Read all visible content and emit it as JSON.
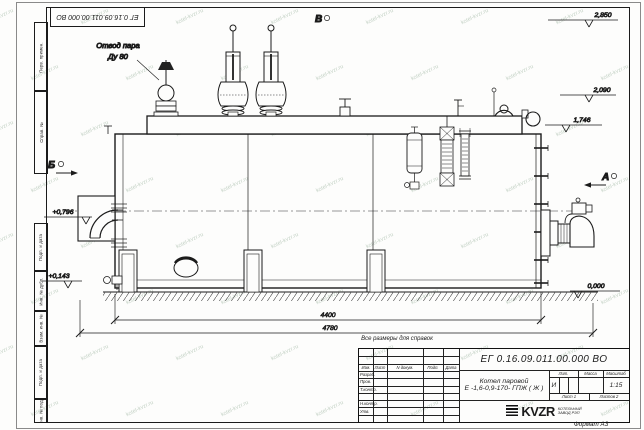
{
  "watermark": {
    "text": "kotel-kvzr.ru"
  },
  "frame": {
    "doc_number_top": "ЕГ 0.16.09.011.00.000  ВО",
    "format_label": "Формат А3",
    "side_stamps": [
      "Перв. примен.",
      "Справ. №",
      "Подп. и дата",
      "Инв. № дубл.",
      "Взам. инв. №",
      "Подп. и дата",
      "Инв. № подл."
    ]
  },
  "drawing": {
    "callout_line1": "Отвод пара",
    "callout_line2": "Ду 80",
    "views": {
      "a": "А",
      "b": "Б",
      "v": "В"
    },
    "elevations": {
      "top": "2,850",
      "upper": "2,090",
      "drum": "1,746",
      "axis": "+0,796",
      "base": "+0,143",
      "zero": "0,000"
    },
    "dimensions": {
      "boiler_length": "4400",
      "overall_length": "4780"
    },
    "note": "Все размеры для справок"
  },
  "titleblock": {
    "doc_number": "ЕГ 0.16.09.011.00.000  ВО",
    "product_name_line1": "Котел паровой",
    "product_name_line2": "Е -1,6-0,9-170- ГПЖ ( Ж )",
    "cols": {
      "izm": "Изм.",
      "list": "Лист",
      "ndoc": "N докум.",
      "podp": "Подп.",
      "data": "Дата"
    },
    "rows": {
      "razrab": "Разраб.",
      "prov": "Пров.",
      "tkontr": "Т.контр.",
      "nkontr": "Н.контр.",
      "utv": "Утв."
    },
    "right": {
      "lit_h": "Лит.",
      "massa_h": "Масса",
      "scale_h": "Масштаб",
      "lit": "И",
      "scale": "1:15",
      "sheet": "Лист  1",
      "sheets": "Листов  2"
    },
    "logo": {
      "name": "KVZR",
      "tag1": "КОТЕЛЬНЫЙ",
      "tag2": "ЗАВОД РЭП"
    }
  }
}
